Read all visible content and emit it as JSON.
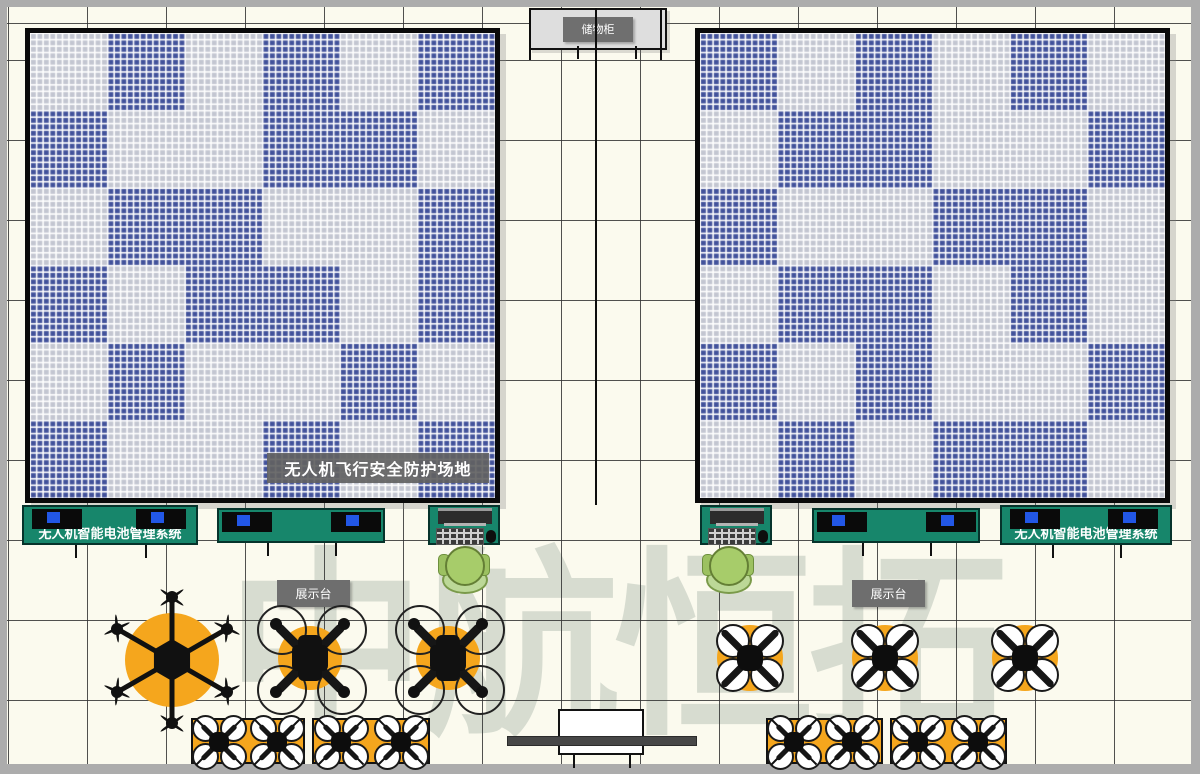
{
  "watermark": {
    "text": "中航恒拓"
  },
  "labels": {
    "storage_cabinet": "储物柜",
    "flight_field": "无人机飞行安全防护场地",
    "battery_system": "无人机智能电池管理系统",
    "display_stand": "展示台"
  },
  "colors": {
    "floor": "#FBFAEE",
    "frame": "#ACACAC",
    "tile_blue": "#42529B",
    "tile_gray": "#C3C6D1",
    "tile_gap": "#FFFFFF",
    "table_green": "#17866B",
    "laptop_screen": "#2257E6",
    "drone_orange": "#F5A61D",
    "person_green": "#A7CC6A",
    "label_gray": "#6E6E6E",
    "wall_black": "#0D0D0D"
  }
}
